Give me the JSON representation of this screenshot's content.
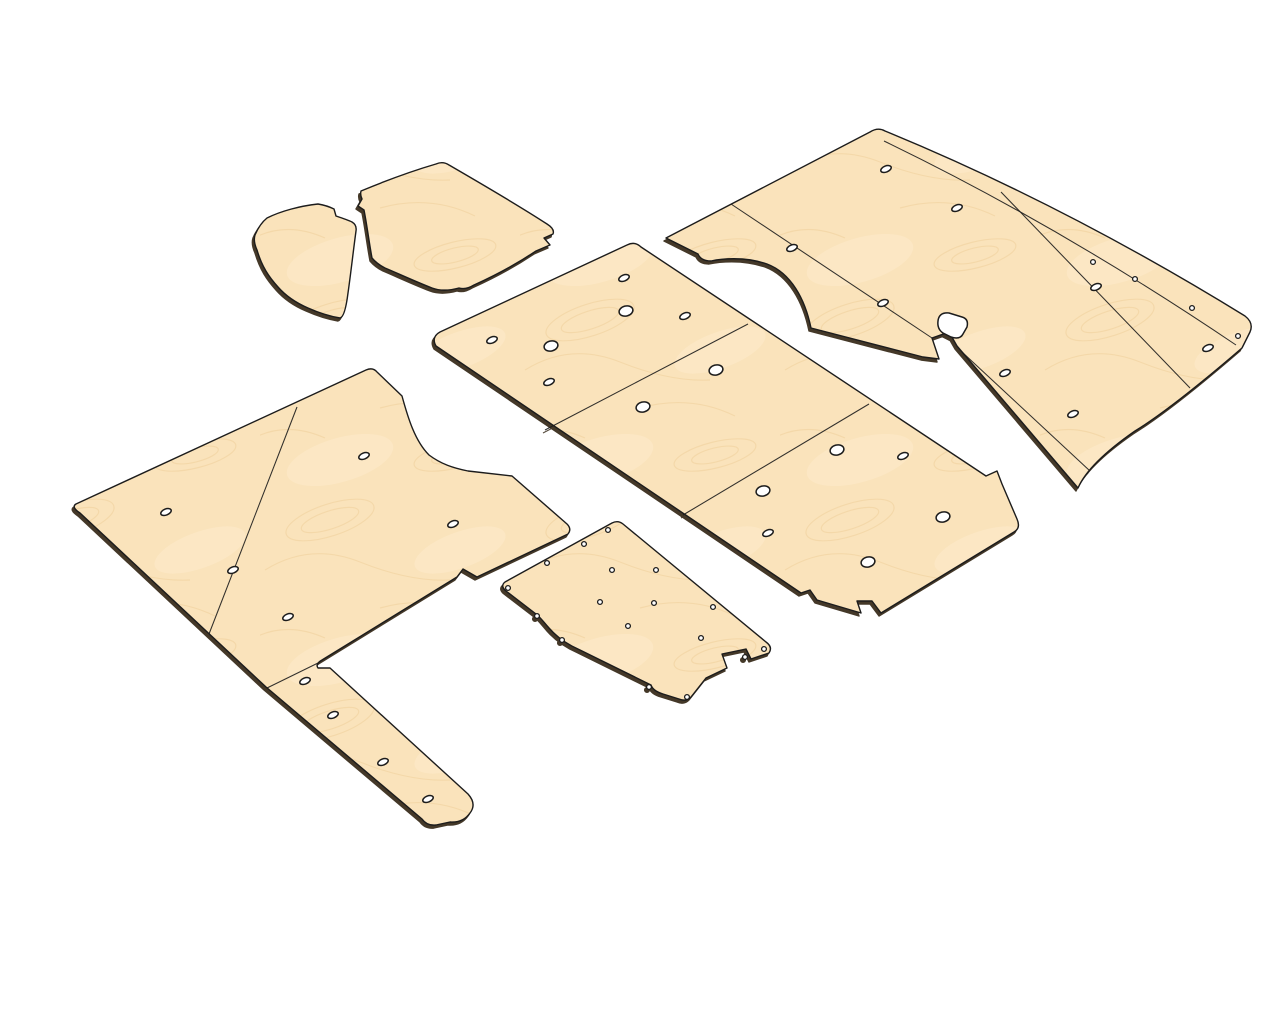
{
  "scene": {
    "background": "#ffffff",
    "panel_fill": "#fae3bb",
    "grain_color": "#efd09a",
    "grain_light": "#fdeccd",
    "outline_color": "#1c1c1c",
    "edge_shadow": "rgba(48,34,17,0.9)",
    "hole_fill": "#ffffff",
    "canvas_width": 1280,
    "canvas_height": 1024
  },
  "panels": [
    {
      "name": "cab-mat-left",
      "outline": "M 318,204 C 324,205 330,207 334,209 L 336,216 C 342,218 348,220 352,222 Q 357,225 356,231 C 353,253 351,272 348,293 Q 345,317 340,318 C 328,316 317,312 308,308 C 294,302 285,295 278,287 C 269,277 262,267 257,250 Q 253,241 255,235 C 258,228 262,222 267,218 C 281,211 300,206 318,204 Z",
      "seams": [],
      "cutouts": [],
      "holes": {
        "round": [],
        "oval": [],
        "dot": []
      }
    },
    {
      "name": "cab-mat-right",
      "outline": "M 361,191 C 385,181 412,171 436,164 Q 443,161 449,165 C 480,183 518,205 547,224 Q 555,229 553,234 L 544,238 L 550,245 L 536,251 C 518,263 494,276 474,285 Q 466,290 459,288 C 448,291 440,291 432,288 C 414,281 397,273 385,268 Q 377,264 372,258 C 369,242 367,225 364,210 L 358,206 L 362,199 Q 360,195 361,191 Z",
      "seams": [],
      "cutouts": [],
      "holes": {
        "round": [],
        "oval": [],
        "dot": []
      }
    },
    {
      "name": "right-wall-panel-group",
      "outline": "M 666,238 L 870,132 Q 878,127 885,131 Q 1065,205 1245,316 Q 1254,323 1250,332 L 1242,348 C 1213,373 1166,412 1135,431 Q 1089,463 1078,488 L 957,346 L 949,332 L 932,338 L 939,359 L 923,357 L 811,328 C 805,299 791,273 767,264 C 744,256 720,259 711,261 Q 701,261 698,254 Z",
      "seams": [
        "M 884,141 Q 1060,226 1236,345",
        "M 731,204 L 932,338",
        "M 1001,192 L 1190,388",
        "M 962,352 L 1090,471"
      ],
      "cutouts": [
        "M 938,321 Q 939,312 949,313 L 962,317 Q 969,319 967,327 L 963,334 Q 960,340 951,337 L 943,333 Q 937,329 938,321 Z"
      ],
      "holes": {
        "round": [],
        "oval": [
          [
            886,
            169
          ],
          [
            957,
            208
          ],
          [
            792,
            248
          ],
          [
            883,
            303
          ],
          [
            684,
            315
          ],
          [
            1096,
            287
          ],
          [
            1208,
            348
          ],
          [
            1005,
            373
          ],
          [
            1073,
            414
          ]
        ],
        "dot": [
          [
            1093,
            262
          ],
          [
            1135,
            279
          ],
          [
            1192,
            308
          ],
          [
            1238,
            336
          ]
        ]
      }
    },
    {
      "name": "floor-panel",
      "outline": "M 440,332 L 627,245 Q 635,241 641,247 L 986,476 L 997,471 L 1002,484 L 1017,519 Q 1021,528 1014,532 L 881,613 L 872,601 L 857,601 L 861,613 L 817,600 L 810,590 L 801,593 L 436,346 Q 431,337 440,332 Z",
      "seams": [
        "M 748,324 L 545,430",
        "M 869,404 L 683,515"
      ],
      "cutouts": [],
      "holes": {
        "round": [
          [
            626,
            311
          ],
          [
            551,
            346
          ],
          [
            716,
            370
          ],
          [
            643,
            407
          ],
          [
            837,
            450
          ],
          [
            763,
            491
          ],
          [
            868,
            562
          ],
          [
            943,
            517
          ]
        ],
        "oval": [
          [
            624,
            278
          ],
          [
            685,
            316
          ],
          [
            492,
            340
          ],
          [
            549,
            382
          ],
          [
            903,
            456
          ],
          [
            768,
            533
          ]
        ],
        "dot": []
      }
    },
    {
      "name": "left-wall-panel-group",
      "outline": "M 76,504 L 366,370 Q 373,367 377,372 L 402,396 C 408,418 415,441 429,455 C 441,464 453,468 468,471 L 512,476 L 567,524 Q 572,529 568,534 L 477,577 L 463,569 L 457,577 L 322,660 Q 315,664 318,668 L 330,668 L 468,794 Q 477,804 470,813 Q 463,823 450,822 L 436,825 Q 427,826 422,819 L 266,687 L 80,513 Q 71,507 76,504 Z",
      "seams": [
        "M 297,407 L 209,634",
        "M 318,663 L 267,688"
      ],
      "cutouts": [],
      "holes": {
        "round": [],
        "oval": [
          [
            364,
            456
          ],
          [
            453,
            524
          ],
          [
            166,
            512
          ],
          [
            233,
            570
          ],
          [
            288,
            617
          ],
          [
            305,
            681
          ],
          [
            333,
            715
          ],
          [
            383,
            762
          ],
          [
            428,
            799
          ]
        ],
        "dot": []
      }
    },
    {
      "name": "bulkhead-panel",
      "outline": "M 612,523 Q 618,520 623,524 L 766,642 Q 773,647 769,653 L 751,659 L 746,649 L 722,654 L 727,668 L 706,678 L 691,697 Q 686,702 679,699 L 663,694 Q 653,691 651,685 L 580,650 C 566,644 556,636 549,628 C 542,620 540,617 536,614 L 506,591 Q 500,586 505,582 Z",
      "seams": [],
      "cutouts": [],
      "holes": {
        "round": [],
        "oval": [],
        "dot": [
          [
            608,
            530
          ],
          [
            584,
            544
          ],
          [
            547,
            563
          ],
          [
            508,
            588
          ],
          [
            537,
            616
          ],
          [
            562,
            640
          ],
          [
            649,
            687
          ],
          [
            687,
            697
          ],
          [
            745,
            657
          ],
          [
            764,
            649
          ],
          [
            713,
            607
          ],
          [
            701,
            638
          ],
          [
            612,
            570
          ],
          [
            600,
            602
          ],
          [
            656,
            570
          ],
          [
            654,
            603
          ],
          [
            628,
            626
          ]
        ]
      }
    }
  ],
  "hole_styles": {
    "round": {
      "rx": 7,
      "ry": 5,
      "rotate": -14
    },
    "oval": {
      "rx": 5.5,
      "ry": 3,
      "rotate": -22
    },
    "dot": {
      "r": 2.4
    }
  }
}
